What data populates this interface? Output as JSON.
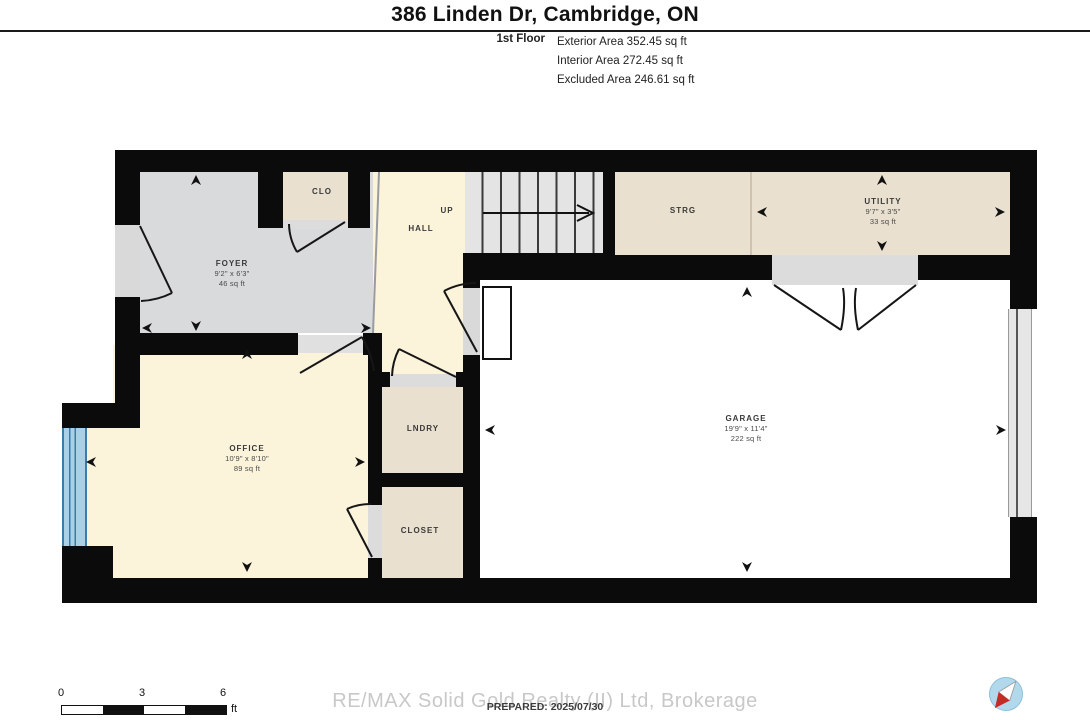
{
  "header": {
    "title": "386 Linden Dr, Cambridge, ON",
    "floor_label": "1st Floor",
    "area_lines": [
      "Exterior Area 352.45 sq ft",
      "Interior Area 272.45 sq ft",
      "Excluded Area 246.61 sq ft"
    ]
  },
  "rooms": {
    "foyer": {
      "name": "FOYER",
      "dims": "9'2\" x 6'3\"",
      "area": "46 sq ft"
    },
    "clo": {
      "name": "CLO"
    },
    "hall": {
      "name": "HALL"
    },
    "strg": {
      "name": "STRG"
    },
    "utility": {
      "name": "UTILITY",
      "dims": "9'7\" x 3'5\"",
      "area": "33 sq ft"
    },
    "office": {
      "name": "OFFICE",
      "dims": "10'9\" x 8'10\"",
      "area": "89 sq ft"
    },
    "lndry": {
      "name": "LNDRY"
    },
    "closet": {
      "name": "CLOSET"
    },
    "garage": {
      "name": "GARAGE",
      "dims": "19'9\" x 11'4\"",
      "area": "222 sq ft"
    }
  },
  "stairs": {
    "direction_label": "UP"
  },
  "scale_bar": {
    "ticks": [
      "0",
      "3",
      "6"
    ],
    "unit": "ft"
  },
  "footer": {
    "watermark": "RE/MAX Solid Gold Realty (II) Ltd, Brokerage",
    "prepared_label": "PREPARED: 2025/07/30"
  },
  "colors": {
    "wall": "#0b0b0b",
    "foyer_floor": "#d9dadc",
    "hall_floor": "#fbf3da",
    "storage_floor": "#e9e0cf",
    "garage_floor": "#ffffff",
    "window_blue": "#aacfe6",
    "logo_blue": "#b2d8ec",
    "logo_red": "#c32b25",
    "watermark_gray": "#c8c8c8"
  }
}
